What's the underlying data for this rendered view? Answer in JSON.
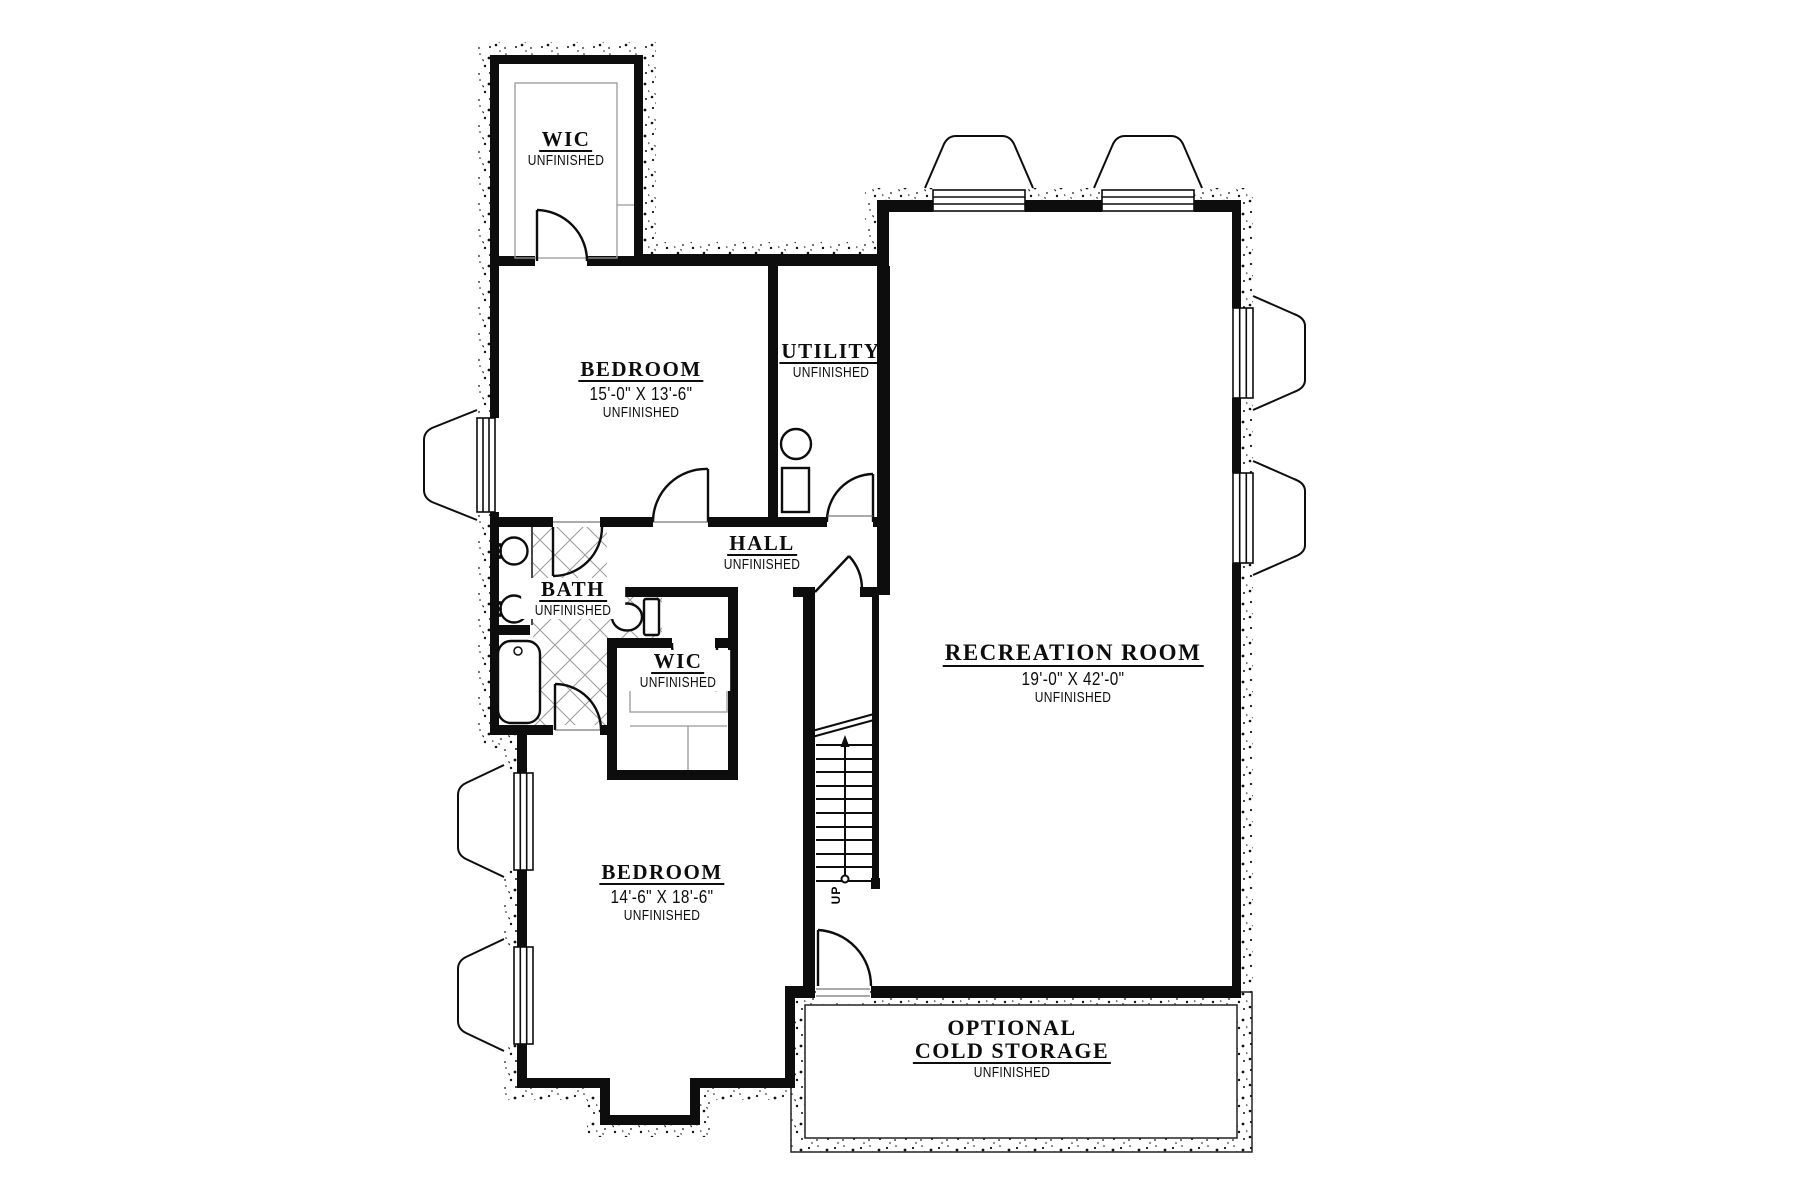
{
  "drawing": {
    "type": "basement floor plan",
    "wall_color": "#0d0d0d",
    "tile_line_color": "#9a9a9a",
    "closet_line_color": "#999999"
  },
  "rooms": {
    "wic_upper": {
      "name": "WIC",
      "status": "UNFINISHED"
    },
    "bedroom_upper": {
      "name": "BEDROOM",
      "dimensions": "15'-0\" X 13'-6\"",
      "status": "UNFINISHED"
    },
    "utility": {
      "name": "UTILITY",
      "status": "UNFINISHED"
    },
    "hall": {
      "name": "HALL",
      "status": "UNFINISHED"
    },
    "bath": {
      "name": "BATH",
      "status": "UNFINISHED"
    },
    "wic_lower": {
      "name": "WIC",
      "status": "UNFINISHED"
    },
    "recreation": {
      "name": "RECREATION ROOM",
      "dimensions": "19'-0\" X 42'-0\"",
      "status": "UNFINISHED"
    },
    "bedroom_lower": {
      "name": "BEDROOM",
      "dimensions": "14'-6\" X 18'-6\"",
      "status": "UNFINISHED"
    },
    "cold_storage": {
      "name_line1": "OPTIONAL",
      "name_line2": "COLD STORAGE",
      "status": "UNFINISHED"
    },
    "stairs": {
      "direction": "UP"
    }
  }
}
